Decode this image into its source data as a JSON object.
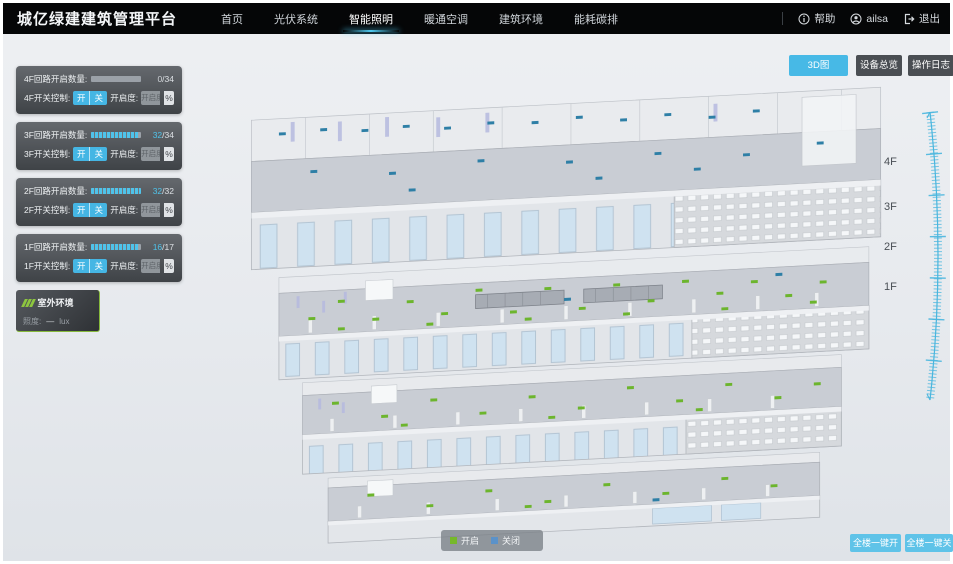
{
  "header": {
    "title": "城亿绿建建筑管理平台",
    "nav": [
      {
        "label": "首页",
        "active": false
      },
      {
        "label": "光伏系统",
        "active": false
      },
      {
        "label": "智能照明",
        "active": true
      },
      {
        "label": "暖通空调",
        "active": false
      },
      {
        "label": "建筑环境",
        "active": false
      },
      {
        "label": "能耗碳排",
        "active": false
      }
    ],
    "help_label": "帮助",
    "user_name": "ailsa",
    "logout_label": "退出"
  },
  "icons": {
    "help": "info-circle",
    "user": "user-circle",
    "logout": "logout-arrow",
    "outdoor": "green-slashes"
  },
  "toolbar": {
    "view_3d_label": "3D图",
    "device_overview_label": "设备总览",
    "operation_log_label": "操作日志"
  },
  "floor_panels": [
    {
      "floor": "4F",
      "circuit_label": "4F回路开启数量:",
      "open": "0",
      "total": "/34",
      "open_count": 0,
      "total_count": 34,
      "fill_pct": 0,
      "switch_label": "4F开关控制:",
      "on_label": "开",
      "off_label": "关",
      "dim_label": "开启度:",
      "dim_placeholder": "开启度",
      "percent_label": "%"
    },
    {
      "floor": "3F",
      "circuit_label": "3F回路开启数量:",
      "open": "32",
      "total": "/34",
      "open_count": 32,
      "total_count": 34,
      "fill_pct": 94,
      "switch_label": "3F开关控制:",
      "on_label": "开",
      "off_label": "关",
      "dim_label": "开启度:",
      "dim_placeholder": "开启度",
      "percent_label": "%"
    },
    {
      "floor": "2F",
      "circuit_label": "2F回路开启数量:",
      "open": "32",
      "total": "/32",
      "open_count": 32,
      "total_count": 32,
      "fill_pct": 100,
      "switch_label": "2F开关控制:",
      "on_label": "开",
      "off_label": "关",
      "dim_label": "开启度:",
      "dim_placeholder": "开启度",
      "percent_label": "%"
    },
    {
      "floor": "1F",
      "circuit_label": "1F回路开启数量:",
      "open": "16",
      "total": "/17",
      "open_count": 16,
      "total_count": 17,
      "fill_pct": 94,
      "switch_label": "1F开关控制:",
      "on_label": "开",
      "off_label": "关",
      "dim_label": "开启度:",
      "dim_placeholder": "开启度",
      "percent_label": "%"
    }
  ],
  "outdoor_panel": {
    "title": "室外环境",
    "metric_label": "照度:",
    "metric_value": "—",
    "metric_unit": "lux"
  },
  "floor_scale": {
    "labels": [
      "4F",
      "3F",
      "2F",
      "1F"
    ]
  },
  "legend": {
    "on_label": "开启",
    "off_label": "关闭"
  },
  "footer_buttons": {
    "all_on_label": "全楼一键开",
    "all_off_label": "全楼一键关"
  },
  "colors": {
    "accent_cyan": "#45b6e4",
    "nav_underline": "#4ec9f0",
    "legend_on_green": "#76b82a",
    "legend_off_blue": "#5b92c9",
    "marker_on_green": "#6cb52d",
    "marker_off_blue": "#2e7fa6",
    "panel_dark": "#43474c",
    "header_black": "#050607"
  }
}
